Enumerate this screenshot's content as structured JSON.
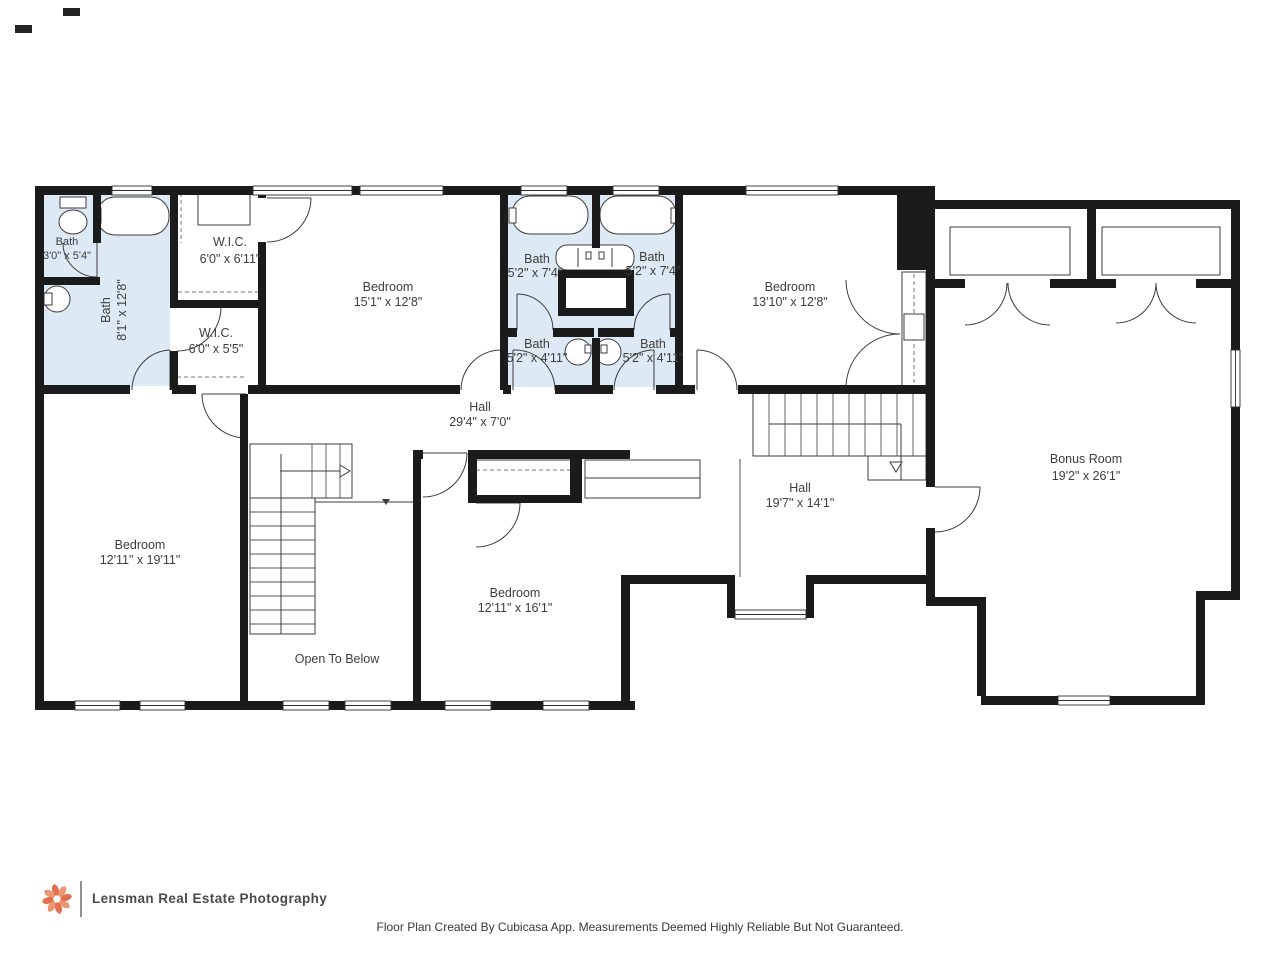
{
  "plan": {
    "rooms": [
      {
        "label": "Bath",
        "dims": "3'0\" x 5'4\""
      },
      {
        "label": "Bath",
        "dims": "8'1\" x 12'8\""
      },
      {
        "label": "W.I.C.",
        "dims": "6'0\" x 6'11\""
      },
      {
        "label": "W.I.C.",
        "dims": "6'0\" x 5'5\""
      },
      {
        "label": "Bedroom",
        "dims": "15'1\" x 12'8\""
      },
      {
        "label": "Bath",
        "dims": "5'2\" x 7'4\""
      },
      {
        "label": "Bath",
        "dims": "5'2\" x 7'4\""
      },
      {
        "label": "Bath",
        "dims": "5'2\" x 4'11\""
      },
      {
        "label": "Bath",
        "dims": "5'2\" x 4'11\""
      },
      {
        "label": "Bedroom",
        "dims": "13'10\" x 12'8\""
      },
      {
        "label": "Hall",
        "dims": "29'4\" x 7'0\""
      },
      {
        "label": "Hall",
        "dims": "19'7\" x 14'1\""
      },
      {
        "label": "Bonus Room",
        "dims": "19'2\" x 26'1\""
      },
      {
        "label": "Bedroom",
        "dims": "12'11\" x 19'11\""
      },
      {
        "label": "Bedroom",
        "dims": "12'11\" x 16'1\""
      },
      {
        "label": "Open To Below",
        "dims": ""
      }
    ],
    "colors": {
      "wall": "#1b1b1b",
      "bath_fill": "#dde9f4"
    }
  },
  "footer": {
    "brand": "Lensman Real Estate Photography",
    "logo_color": "#e2704c",
    "disclaimer": "Floor Plan Created By Cubicasa App. Measurements Deemed Highly Reliable But Not Guaranteed."
  }
}
